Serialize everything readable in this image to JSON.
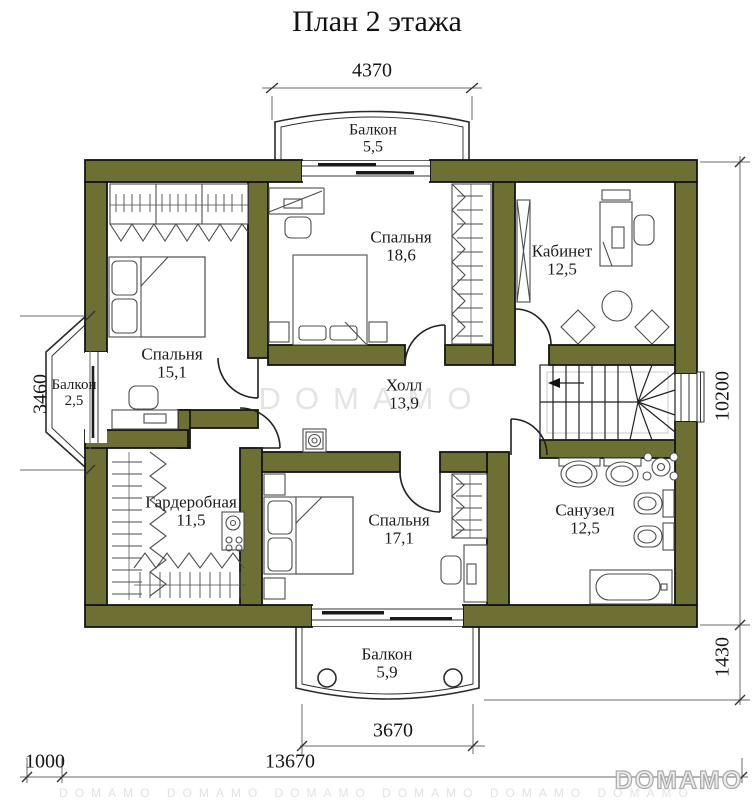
{
  "title": "План 2 этажа",
  "colors": {
    "wall": "#6E7033",
    "line": "#1a1a1a"
  },
  "rooms": {
    "balcony_top": {
      "name": "Балкон",
      "area": "5,5"
    },
    "bedroom_large": {
      "name": "Спальня",
      "area": "18,6"
    },
    "office": {
      "name": "Кабинет",
      "area": "12,5"
    },
    "bedroom_left": {
      "name": "Спальня",
      "area": "15,1"
    },
    "balcony_left": {
      "name": "Балкон",
      "area": "2,5"
    },
    "hall": {
      "name": "Холл",
      "area": "13,9"
    },
    "wardrobe": {
      "name": "Гардеробная",
      "area": "11,5"
    },
    "bedroom_bottom": {
      "name": "Спальня",
      "area": "17,1"
    },
    "bathroom": {
      "name": "Санузел",
      "area": "12,5"
    },
    "balcony_bottom": {
      "name": "Балкон",
      "area": "5,9"
    }
  },
  "dimensions": {
    "top": "4370",
    "left": "3460",
    "right": "10200",
    "right_lower": "1430",
    "balcony_bottom": "3670",
    "total_bottom": "13670",
    "offset_left": "1000"
  },
  "watermarks": {
    "center": "DOMAMO",
    "logo": "DOMAMO",
    "strip": "DOMAMO DOMAMO DOMAMO DOMAMO DOMAMO DOMAMO"
  }
}
